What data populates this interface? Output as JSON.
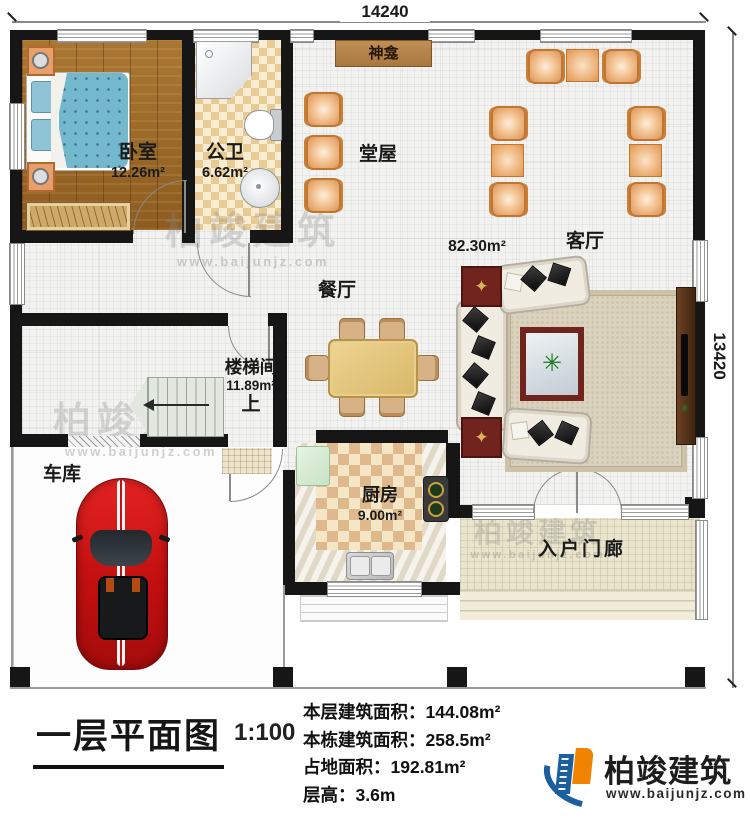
{
  "dimensions": {
    "width_label": "14240",
    "height_label": "13420"
  },
  "rooms": {
    "bedroom": {
      "name": "卧室",
      "area": "12.26m²"
    },
    "bathroom": {
      "name": "公卫",
      "area": "6.62m²"
    },
    "shrine": {
      "name": "神龛"
    },
    "hall": {
      "name": "堂屋"
    },
    "living": {
      "name": "客厅",
      "area": "82.30m²"
    },
    "dining": {
      "name": "餐厅"
    },
    "stairwell": {
      "name": "楼梯间",
      "area": "11.89m²",
      "up": "上"
    },
    "garage": {
      "name": "车库"
    },
    "kitchen": {
      "name": "厨房",
      "area": "9.00m²"
    },
    "porch": {
      "name": "入户门廊"
    }
  },
  "caption": {
    "title": "一层平面图",
    "scale": "1:100",
    "stats": [
      {
        "label": "本层建筑面积：",
        "value": "144.08m²"
      },
      {
        "label": "本栋建筑面积：",
        "value": "258.5m²"
      },
      {
        "label": "占地面积：",
        "value": "192.81m²"
      },
      {
        "label": "层高：",
        "value": "3.6m"
      }
    ]
  },
  "brand": {
    "name": "柏竣建筑",
    "url": "www.baijunjz.com"
  },
  "watermark": {
    "text": "柏竣建筑",
    "url": "www.baijunjz.com"
  },
  "icons": {
    "plant": "plant-icon",
    "compass": "compass-star-icon"
  },
  "colors": {
    "wall": "#161616",
    "chair_orange": "#e09a5f",
    "wood_floor": "#9f6c2b",
    "car_red": "#c20f0f",
    "brand_blue": "#1b5f9e",
    "brand_orange": "#f08300",
    "porch": "#e9e4cc",
    "coffee_table_red": "#71231d"
  }
}
